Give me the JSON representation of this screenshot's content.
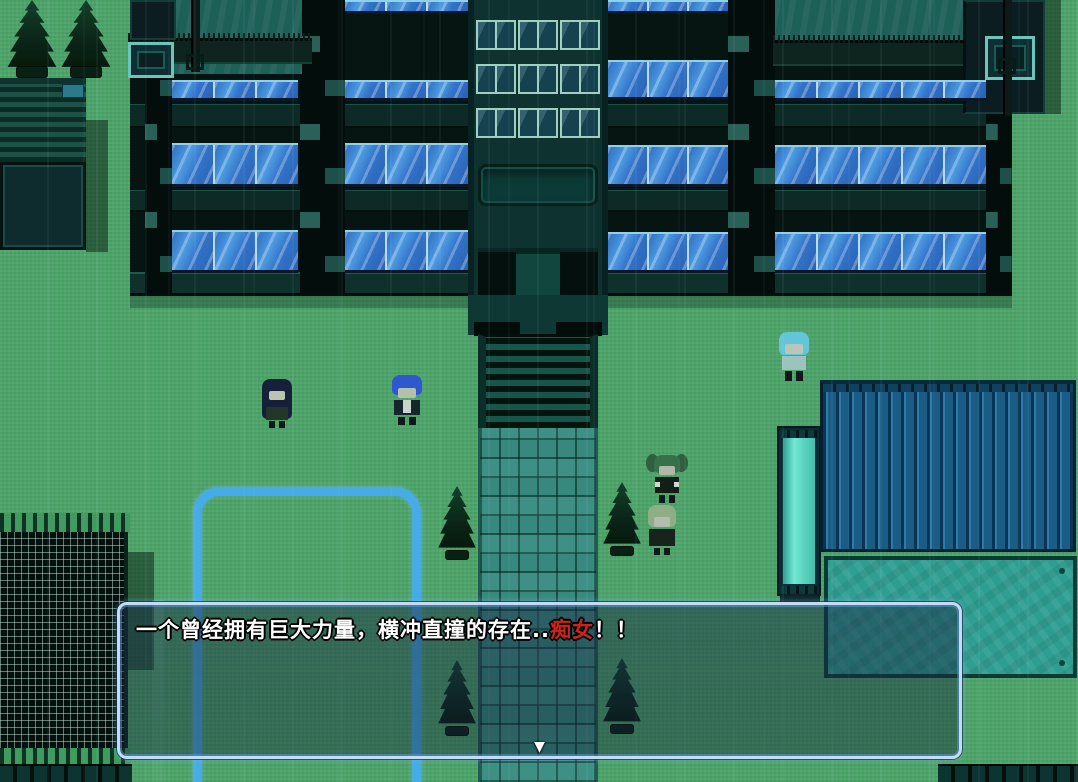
{
  "game": {
    "dialogue": {
      "text_before": "一个曾经拥有巨大力量，横冲直撞的存在..",
      "text_highlight": "痴女",
      "text_after": "！！",
      "highlight_color": "#cc2418",
      "continue_indicator": "▼"
    },
    "palette": {
      "grass": "#4da56a",
      "building_wall": "#061412",
      "window_glass": "#3f87d6",
      "roof_teal": "#1d6058",
      "corrugated_roof": "#1a5c84",
      "platform": "#2f9e92",
      "tank": "#5ad8c6",
      "path_tile": "#38897d",
      "marker_outline": "#46abe6",
      "dialog_border": "#c2dcf6",
      "dialog_text": "#ffffff"
    },
    "characters": [
      {
        "name": "dark-haired-girl"
      },
      {
        "name": "blue-haired-character"
      },
      {
        "name": "cyan-haired-character"
      },
      {
        "name": "twintail-girl"
      },
      {
        "name": "green-haired-girl"
      }
    ]
  }
}
